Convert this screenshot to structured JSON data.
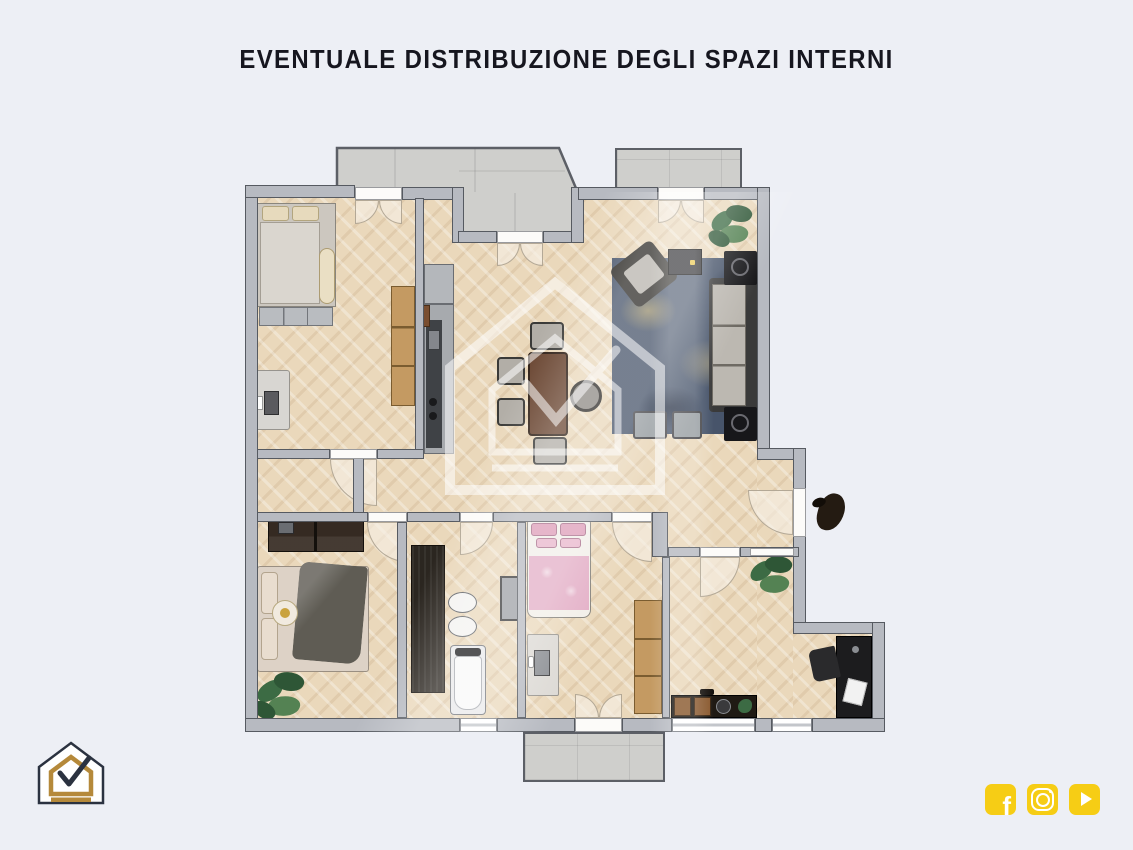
{
  "title": "EVENTUALE DISTRIBUZIONE DEGLI SPAZI INTERNI",
  "plan": {
    "type": "apartment-floor-plan",
    "watermark_icon": "house-check-watermark",
    "colors": {
      "background": "#edeff5",
      "title_text": "#16161f",
      "wall": "#b7bac1",
      "wall_outline": "#565a61",
      "wood_floor": "#ead8bb",
      "balcony_tile": "#cfcfcc",
      "rug": "#47546a",
      "kids_bed_pink": "#e3aec6",
      "plant_green": "#3c6b44",
      "accent_yellow": "#f6cd15",
      "logo_gold": "#b5893a",
      "logo_dark": "#2b3240"
    }
  },
  "footer": {
    "logo_icon": "house-check-logo",
    "social": [
      {
        "name": "facebook",
        "glyph": "f"
      },
      {
        "name": "instagram"
      },
      {
        "name": "youtube"
      }
    ]
  }
}
